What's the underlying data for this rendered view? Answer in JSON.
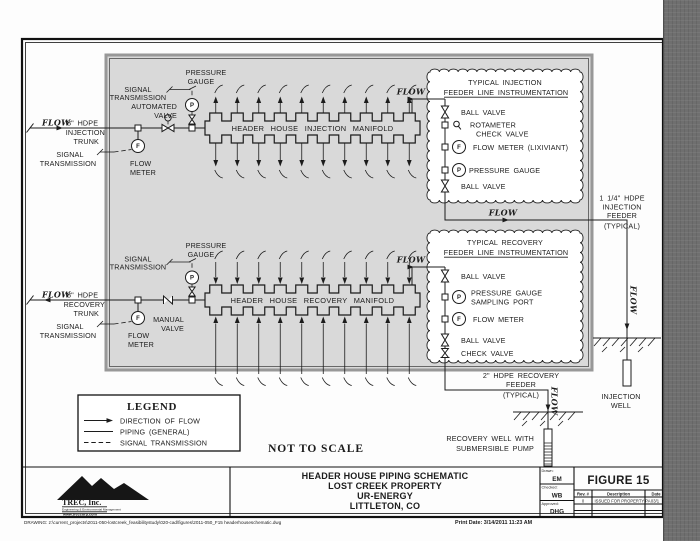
{
  "shared": {
    "flow": "FLOW",
    "sym_p": "P",
    "sym_f": "F"
  },
  "injection": {
    "pressure_gauge": [
      "PRESSURE",
      "GAUGE"
    ],
    "signal_transmission_gauge": [
      "SIGNAL",
      "TRANSMISSION"
    ],
    "automated_valve": [
      "AUTOMATED",
      "VALVE"
    ],
    "trunk": [
      "8\" HDPE",
      "INJECTION",
      "TRUNK"
    ],
    "signal_transmission_meter": [
      "SIGNAL",
      "TRANSMISSION"
    ],
    "flow_meter": [
      "FLOW",
      "METER"
    ],
    "manifold": "HEADER HOUSE INJECTION MANIFOLD",
    "instrumentation": {
      "title": [
        "TYPICAL INJECTION",
        "FEEDER LINE INSTRUMENTATION"
      ],
      "items": [
        "BALL VALVE",
        "ROTAMETER",
        "CHECK VALVE",
        "FLOW METER (LIXIVIANT)",
        "PRESSURE GAUGE",
        "BALL VALVE"
      ]
    },
    "feeder": [
      "1 1/4\" HDPE",
      "INJECTION",
      "FEEDER",
      "(TYPICAL)"
    ],
    "well": [
      "INJECTION",
      "WELL"
    ]
  },
  "recovery": {
    "pressure_gauge": [
      "PRESSURE",
      "GAUGE"
    ],
    "signal_transmission_gauge": [
      "SIGNAL",
      "TRANSMISSION"
    ],
    "manual_valve": [
      "MANUAL",
      "VALVE"
    ],
    "trunk": [
      "8\" HDPE",
      "RECOVERY",
      "TRUNK"
    ],
    "signal_transmission_meter": [
      "SIGNAL",
      "TRANSMISSION"
    ],
    "flow_meter": [
      "FLOW",
      "METER"
    ],
    "manifold": "HEADER HOUSE RECOVERY MANIFOLD",
    "instrumentation": {
      "title": [
        "TYPICAL RECOVERY",
        "FEEDER LINE INSTRUMENTATION"
      ],
      "items": [
        "BALL VALVE",
        "PRESSURE GAUGE",
        "SAMPLING PORT",
        "FLOW METER",
        "BALL VALVE",
        "CHECK VALVE"
      ]
    },
    "feeder": [
      "2\" HDPE RECOVERY",
      "FEEDER",
      "(TYPICAL)"
    ],
    "well": [
      "RECOVERY WELL WITH",
      "SUBMERSIBLE PUMP"
    ]
  },
  "legend": {
    "title": "LEGEND",
    "items": [
      "DIRECTION OF FLOW",
      "PIPING (GENERAL)",
      "SIGNAL TRANSMISSION"
    ]
  },
  "not_to_scale": "NOT TO SCALE",
  "title_block": {
    "company": {
      "name": "TREC, Inc.",
      "tagline": "Engineering & Environmental Management",
      "url": "www.treccorp.com"
    },
    "project": [
      "HEADER HOUSE PIPING SCHEMATIC",
      "LOST CREEK PROPERTY",
      "UR-ENERGY",
      "LITTLETON, CO"
    ],
    "figure": "FIGURE 15",
    "approvals": [
      {
        "label": "Drawn:",
        "value": "EM"
      },
      {
        "label": "Checked:",
        "value": "WB"
      },
      {
        "label": "Approved:",
        "value": "DHG"
      }
    ],
    "revisions": {
      "headers": [
        "Rev. #",
        "Description",
        "Date"
      ],
      "rows": [
        [
          "0",
          "ISSUED FOR PROPERTY PA",
          "03/1"
        ]
      ]
    }
  },
  "footer": {
    "drawing_path": "DRAWING: z:\\current_projects\\2011-050-lostcreek_feasibilitystudy\\020-cad\\figures\\2011-050_F15 headerhouseschematic.dwg",
    "print_date": "Print Date: 3/14/2011 11:23 AM"
  }
}
